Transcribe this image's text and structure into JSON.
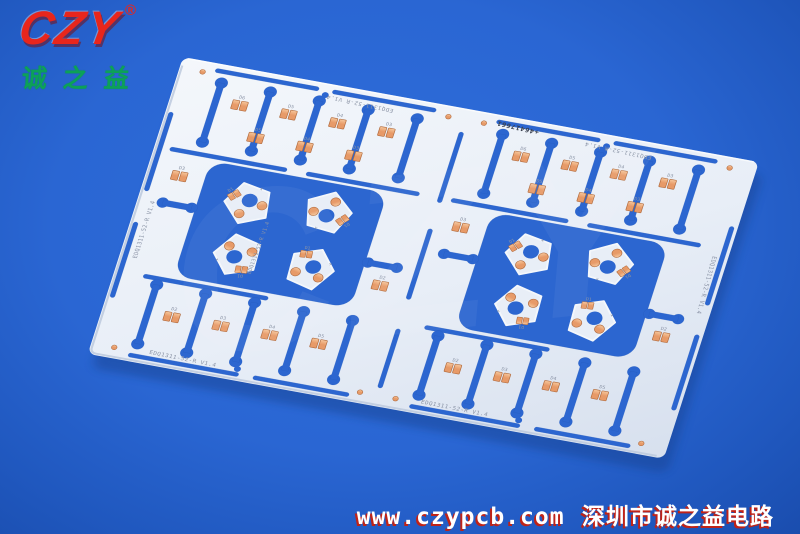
{
  "logo": {
    "brand": "CZY",
    "registered_mark": "®",
    "brand_caption": "诚之益",
    "brand_color": "#e8261c",
    "caption_color": "#0ca158"
  },
  "watermark": {
    "big_text": "CZY",
    "url": "www.czypcb.com",
    "company": "深圳市诚之益电路",
    "text_color": "#ffffff",
    "shadow_color": "#bf2318"
  },
  "pcb": {
    "silkscreen_id": "EDQ1311-52-R",
    "silkscreen_version": "V1.4",
    "serial_number": "+46417661",
    "plus_mark": "+",
    "pad_rows": {
      "top": [
        "D6",
        "D5",
        "D4",
        "D3"
      ],
      "top2": [
        "D5",
        "D4",
        "D3"
      ],
      "bottom": [
        "D2",
        "D3",
        "D4",
        "D5"
      ],
      "mid_left": "D3",
      "mid_right": "D2",
      "pentagon": "D1"
    },
    "colors": {
      "background": "#2a66d3",
      "panel_light": "#f4f7fb",
      "panel": "#e8eef7",
      "panel_dark": "#d7e0ee",
      "panel_shade": "#bcc9dd",
      "slot": "#2c66d0",
      "slot_edge": "#2257b6",
      "copper_light": "#f6c79c",
      "copper": "#e79a68",
      "copper_dark": "#b06a3d",
      "silkscreen": "#8b94a6",
      "serial_ink": "#39404e",
      "shadow": "#14408c"
    }
  }
}
